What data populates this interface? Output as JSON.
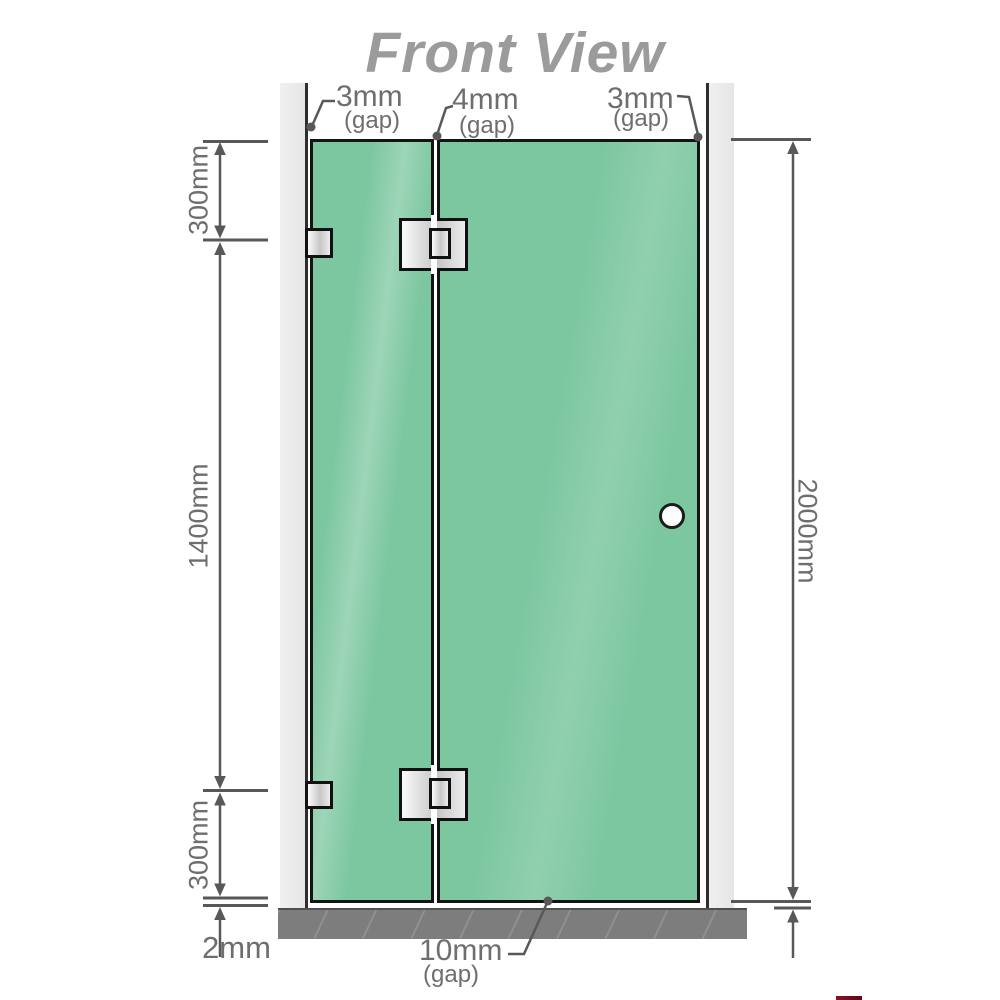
{
  "title": "Front View",
  "diagram": {
    "top_gaps": [
      {
        "value": "3mm",
        "unit": "(gap)"
      },
      {
        "value": "4mm",
        "unit": "(gap)"
      },
      {
        "value": "3mm",
        "unit": "(gap)"
      }
    ],
    "left_dimensions": {
      "top": "300mm",
      "middle": "1400mm",
      "bottom": "300mm"
    },
    "right_dimension": "2000mm",
    "bottom_dimensions": {
      "floor_gap": "2mm",
      "door_gap_value": "10mm",
      "door_gap_unit": "(gap)"
    }
  },
  "colors": {
    "glass": "#7cc7a0",
    "glass_border": "#141414",
    "wall_fill": "#eaeaea",
    "wall_edge": "#2e2e2e",
    "floor": "#7d7d7d",
    "hinge_fill": "#d9d9d9",
    "dimension_lines": "#585858",
    "label_text": "#6e6e6e",
    "title_text": "#9b9b9b"
  }
}
